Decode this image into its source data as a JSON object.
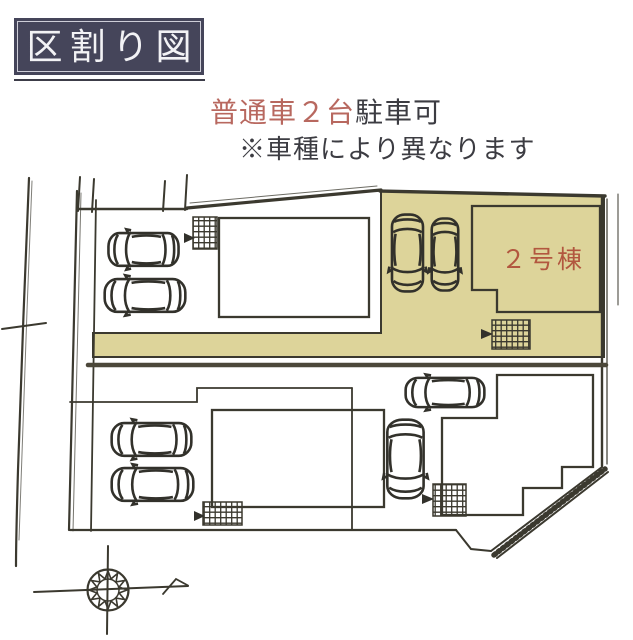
{
  "header": {
    "title": "区割り図"
  },
  "notice": {
    "highlight": "普通車２台",
    "rest": "駐車可",
    "sub": "※車種により異なります"
  },
  "map": {
    "lot_label": "２号棟",
    "icons": [
      "car-icon",
      "hatch-pad-icon",
      "compass-icon",
      "north-arrow-icon"
    ]
  },
  "colors": {
    "title_bg": "#45455a",
    "title_text": "#f2f2f5",
    "notice_highlight": "#b8685f",
    "notice_text": "#3c3c42",
    "lot_highlight": "#ddd49a",
    "lot_label": "#b2573f",
    "sketch_line": "#3b392f"
  }
}
